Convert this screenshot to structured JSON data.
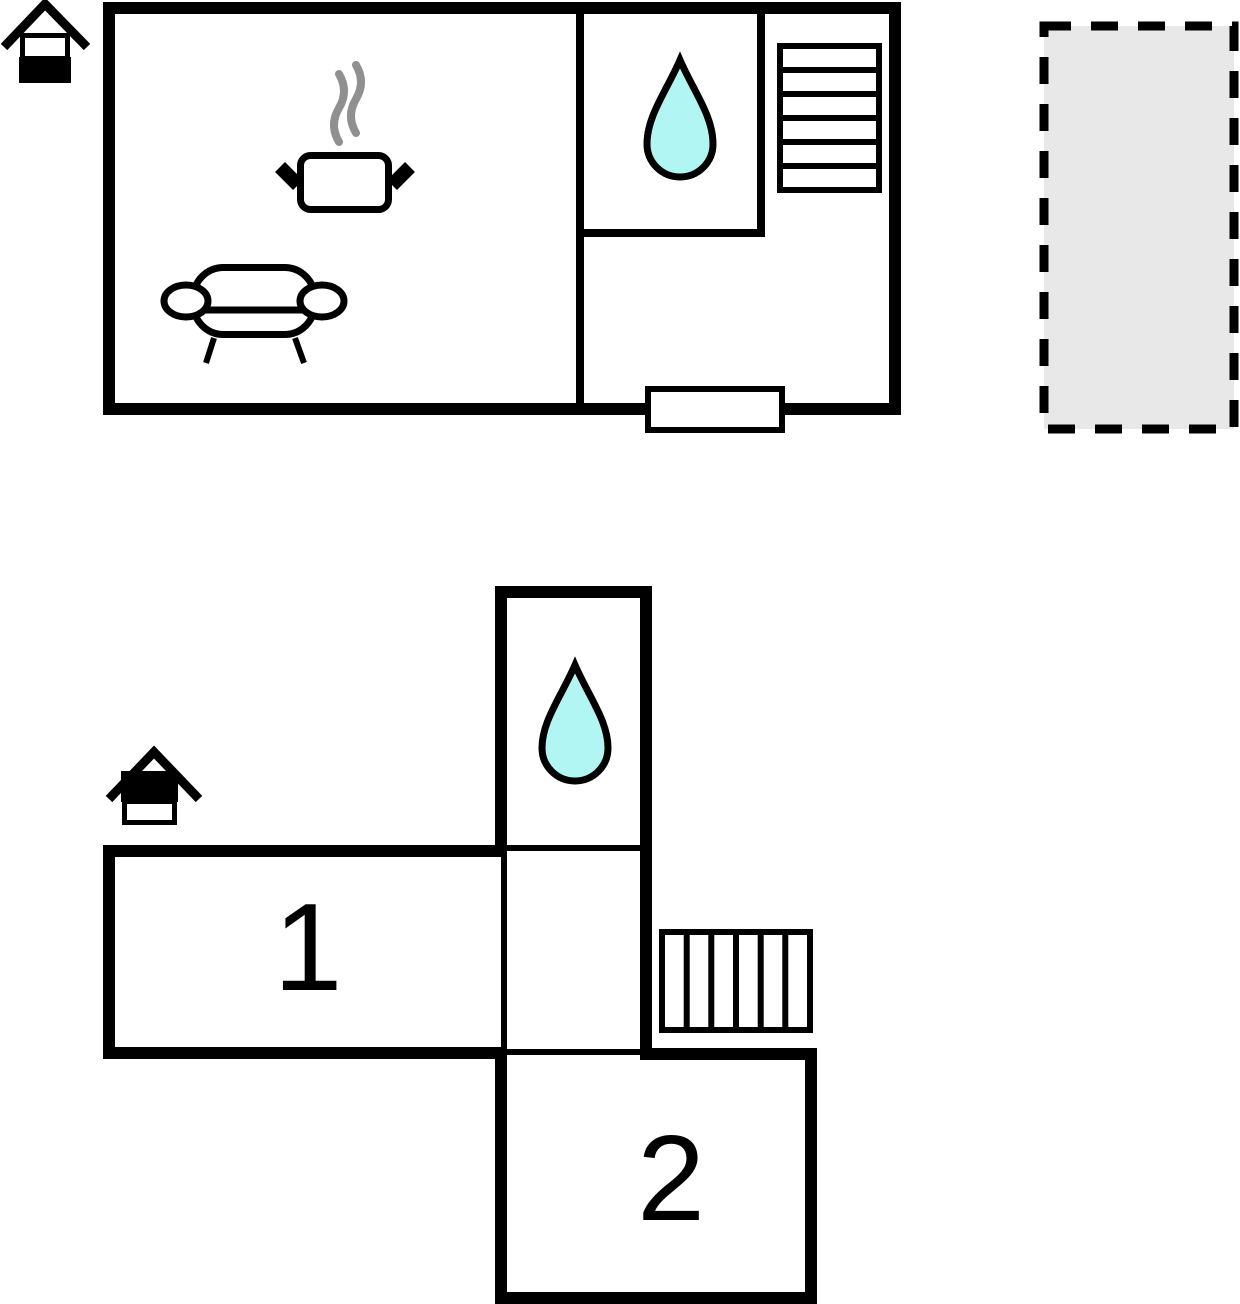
{
  "colors": {
    "wall": "#000000",
    "water": "#b2f6f3",
    "terrace": "#e8e8e8",
    "steam": "#909090",
    "background": "#ffffff"
  },
  "rooms": {
    "room1": {
      "label": "1"
    },
    "room2": {
      "label": "2"
    }
  },
  "icons": [
    "house-level-ground-icon",
    "house-level-upper-icon",
    "cooking-pot-icon",
    "steam-icon",
    "sofa-icon",
    "water-drop-icon",
    "stairs-horizontal-icon",
    "stairs-vertical-icon",
    "entrance-door",
    "terrace-dashed-area"
  ]
}
